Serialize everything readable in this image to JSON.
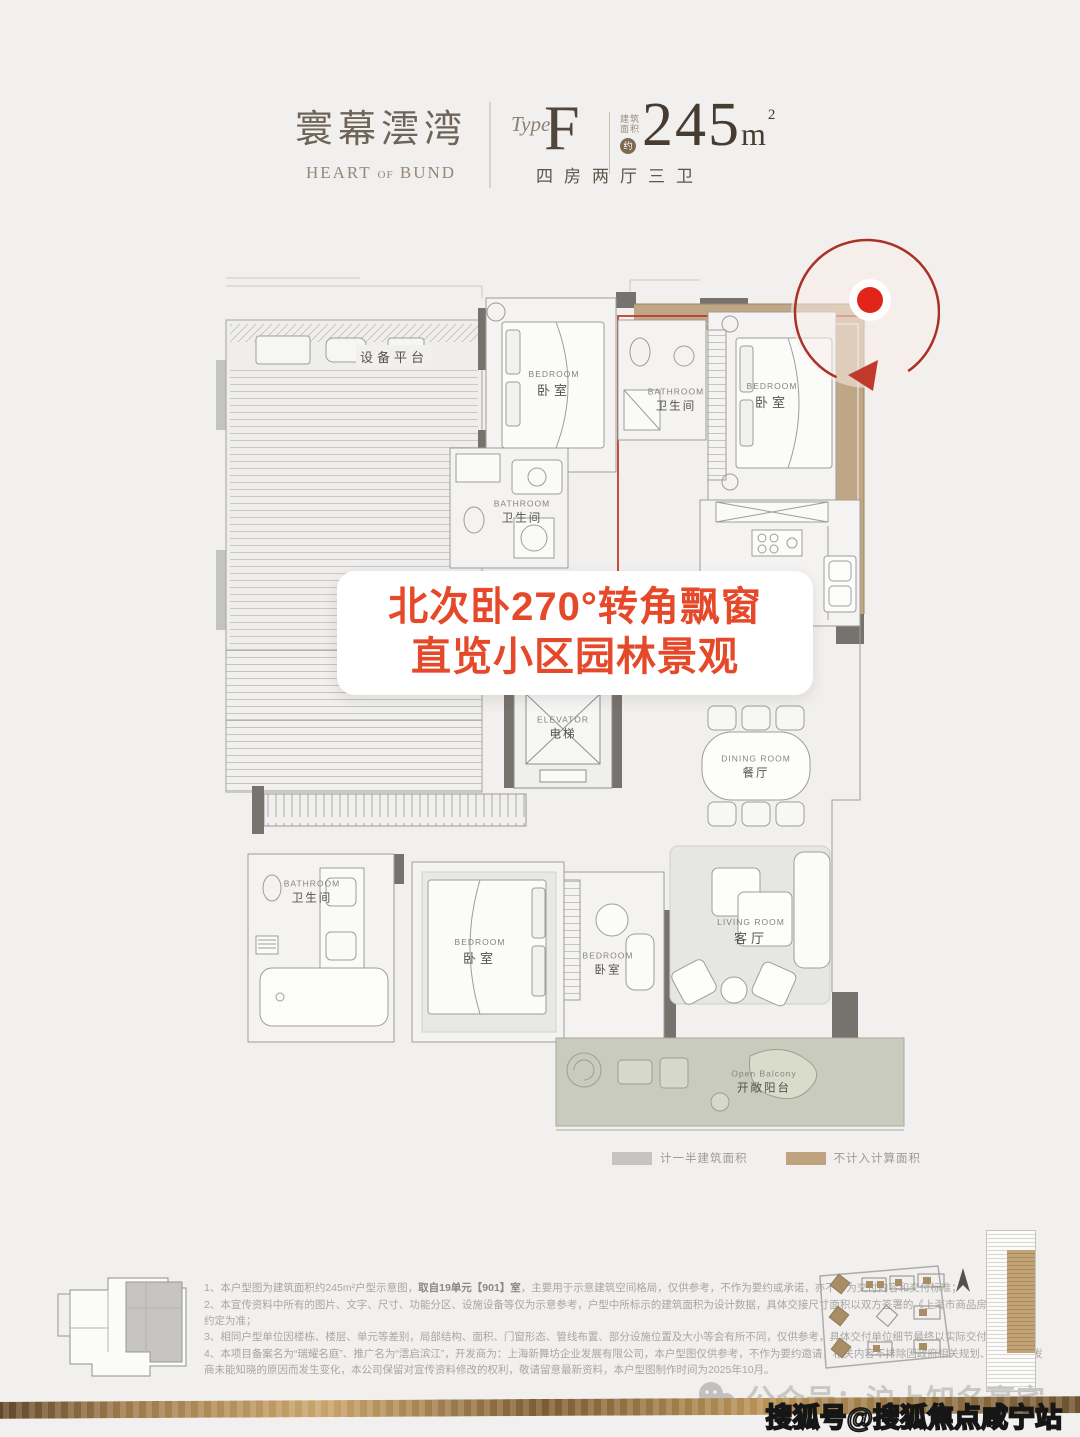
{
  "page": {
    "bg": "#f1f0ee"
  },
  "header": {
    "brand_cn": "寰幕澐湾",
    "brand_en_a": "HEART",
    "brand_en_b": "OF",
    "brand_en_c": "BUND",
    "type_label": "Type",
    "type_value": "F",
    "area_prefix_1": "建筑",
    "area_prefix_2": "面积",
    "area_approx": "约",
    "area_number": "245",
    "area_unit": "m",
    "area_sup": "2",
    "layout_text": "四房两厅三卫"
  },
  "callout": {
    "line1": "北次卧270°转角飘窗",
    "line2": "直览小区园林景观",
    "color": "#e5492a"
  },
  "plan": {
    "highlight_color": "#c23b2a",
    "bay_band_color": "#bfa684",
    "balcony_color": "#c9ccbd",
    "labels": {
      "equipment": {
        "cn": "设备平台"
      },
      "bedroom_north": {
        "en": "BEDROOM",
        "cn": "卧室"
      },
      "bathroom_north": {
        "en": "BATHROOM",
        "cn": "卫生间"
      },
      "bedroom_northeast": {
        "en": "BEDROOM",
        "cn": "卧室"
      },
      "bathroom_middle": {
        "en": "BATHROOM",
        "cn": "卫生间"
      },
      "elevator": {
        "en": "ELEVATOR",
        "cn": "电梯"
      },
      "dining": {
        "en": "DINING ROOM",
        "cn": "餐厅"
      },
      "living": {
        "en": "LIVING ROOM",
        "cn": "客厅"
      },
      "bathroom_south": {
        "en": "BATHROOM",
        "cn": "卫生间"
      },
      "bedroom_south": {
        "en": "BEDROOM",
        "cn": "卧室"
      },
      "bedroom_southeast": {
        "en": "BEDROOM",
        "cn": "卧室"
      },
      "balcony": {
        "en": "Open Balcony",
        "cn": "开敞阳台"
      }
    }
  },
  "legend": {
    "items": [
      {
        "label": "计一半建筑面积",
        "color": "#c5c4c0"
      },
      {
        "label": "不计入计算面积",
        "color": "#bfa27e"
      }
    ]
  },
  "footnotes": {
    "n1_pre": "1、本户型图为建筑面积约245m²户型示意图，",
    "n1_bold": "取自19单元【901】室",
    "n1_post": "，主要用于示意建筑空间格局，仅供参考，不作为要约或承诺，亦不作为交付内容和交付标准；",
    "n2": "2、本宣传资料中所有的图片、文字、尺寸、功能分区、设施设备等仅为示意参考，户型中所标示的建筑面积为设计数据，具体交接尺寸面积以双方签署的《上海市商品房预售合同》约定为准；",
    "n3": "3、相同户型单位因楼栋、楼层、单元等差别，局部结构、面积、门窗形态、管线布置、部分设施位置及大小等会有所不同，仅供参考，具体交付单位细节最终以实际交付为准；",
    "n4": "4、本项目备案名为“瑞耀名庭”、推广名为“澐启滨江”，开发商为：上海新舞坊企业发展有限公司，本户型图仅供参考，不作为要约邀请，相关内容不排除因政府相关规划、规定及开发商未能知晓的原因而发生变化，本公司保留对宣传资料修改的权利，敬请留意最新资料，本户型图制作时间为2025年10月。"
  },
  "watermarks": {
    "wechat": "公众号：沪上知名豪宅",
    "sohu": "搜狐号@搜狐焦点咸宁站"
  }
}
